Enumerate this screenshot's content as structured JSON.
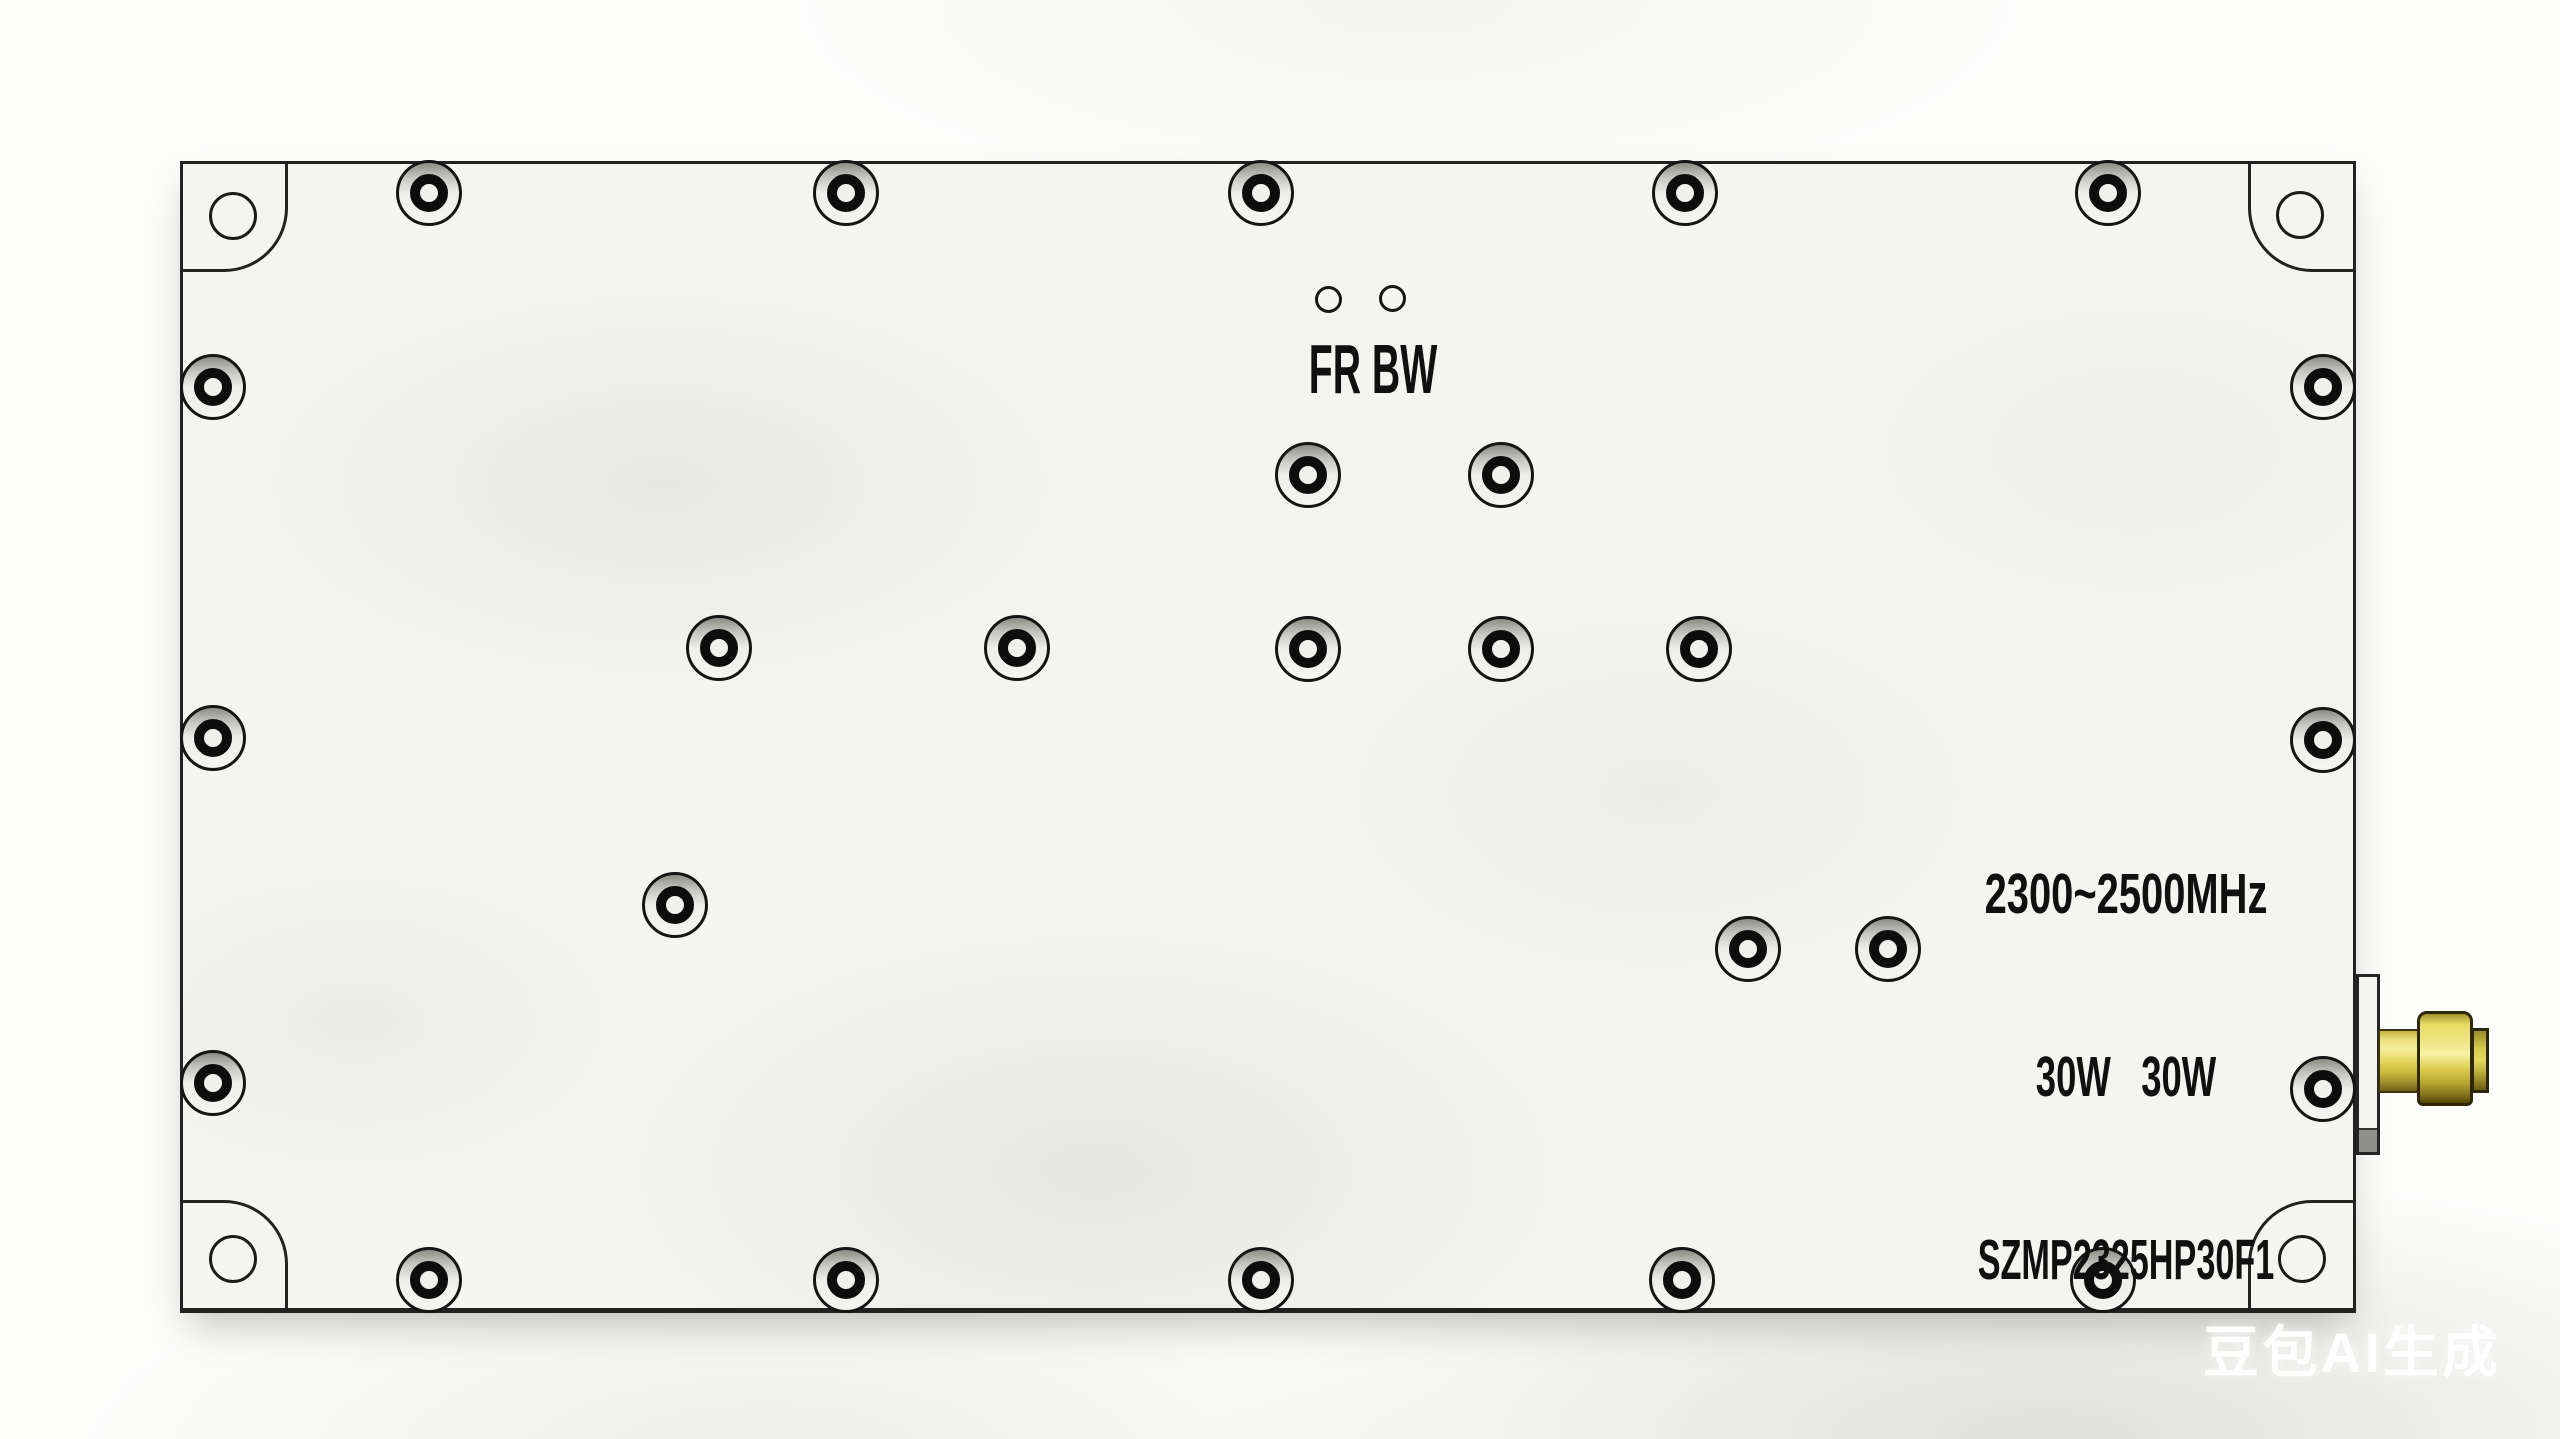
{
  "device_markings": {
    "indicator_labels": "FR BW",
    "frequency_range": "2300~2500MHz",
    "power_rating": "30W   30W",
    "model_number": "SZMP2325HP30F1"
  },
  "watermark_text": "豆包AI生成",
  "colors": {
    "plate": "#f4f4f1",
    "background": "#fdfdfc",
    "outline": "#222222",
    "marking_ink": "#101010",
    "connector_gold_light": "#f7f1a6",
    "connector_gold_dark": "#6e5f16"
  },
  "hardware": {
    "perimeter_screws": [
      [
        429,
        193
      ],
      [
        846,
        193
      ],
      [
        1261,
        193
      ],
      [
        1685,
        193
      ],
      [
        2108,
        193
      ],
      [
        429,
        1280
      ],
      [
        846,
        1280
      ],
      [
        1261,
        1280
      ],
      [
        1682,
        1280
      ],
      [
        2103,
        1280
      ],
      [
        213,
        387
      ],
      [
        213,
        738
      ],
      [
        213,
        1083
      ],
      [
        2323,
        387
      ],
      [
        2323,
        740
      ],
      [
        2323,
        1089
      ]
    ],
    "inner_screws": [
      [
        1308,
        475
      ],
      [
        1501,
        475
      ],
      [
        719,
        648
      ],
      [
        1017,
        648
      ],
      [
        1308,
        649
      ],
      [
        1501,
        649
      ],
      [
        1699,
        649
      ],
      [
        675,
        905
      ],
      [
        1748,
        949
      ],
      [
        1888,
        949
      ]
    ],
    "corner_mount_holes": [
      [
        233,
        216
      ],
      [
        2300,
        215
      ],
      [
        233,
        1259
      ],
      [
        2302,
        1259
      ]
    ],
    "indicator_holes": [
      [
        1328,
        299
      ],
      [
        1392,
        298
      ]
    ]
  }
}
